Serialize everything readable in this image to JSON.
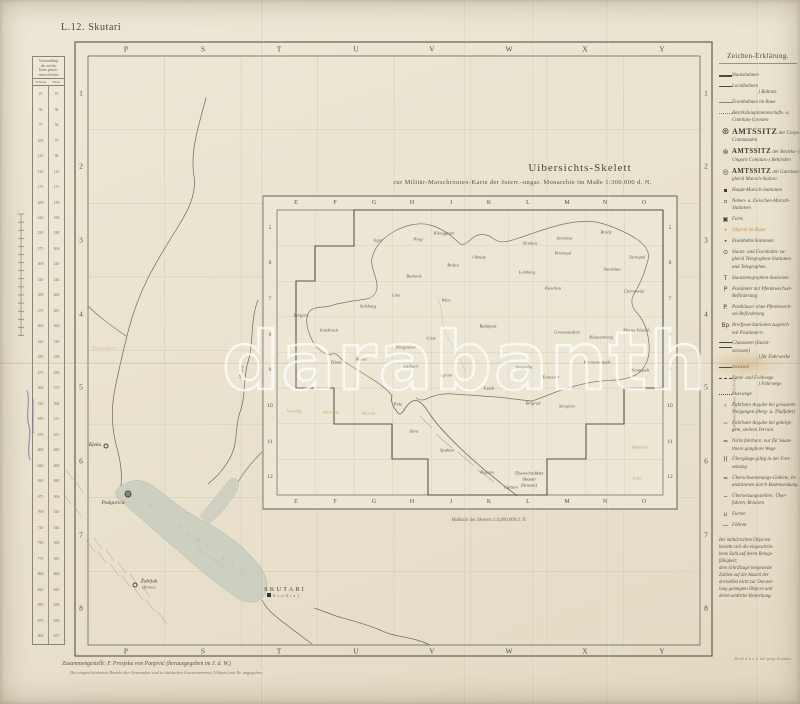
{
  "sheet": {
    "code": "L.12. Skutari"
  },
  "title": {
    "line1": "Uibersichts-Skelett",
    "line2": "zur Militär-Marschrouten-Karte der österr.-ungar. Monarchie im Maße 1:300.000 d. N."
  },
  "frame": {
    "top_letters": [
      "P",
      "S",
      "T",
      "U",
      "V",
      "W",
      "X",
      "Y"
    ],
    "bottom_letters": [
      "P",
      "S",
      "T",
      "U",
      "V",
      "W",
      "X",
      "Y"
    ],
    "left_numbers": [
      "1",
      "2",
      "3",
      "4",
      "5",
      "6",
      "7",
      "8"
    ],
    "right_numbers": [
      "1",
      "2",
      "3",
      "4",
      "5",
      "6",
      "7",
      "8"
    ]
  },
  "conversion_table": {
    "title_lines": [
      "Verwandlung",
      "der auf der",
      "Karte gemes-",
      "senen Schritte"
    ],
    "col_heads": [
      "Schritte",
      "Meter"
    ],
    "rows": [
      [
        "25",
        "19"
      ],
      [
        "50",
        "38"
      ],
      [
        "75",
        "56"
      ],
      [
        "100",
        "75"
      ],
      [
        "125",
        "94"
      ],
      [
        "150",
        "113"
      ],
      [
        "175",
        "131"
      ],
      [
        "200",
        "150"
      ],
      [
        "225",
        "169"
      ],
      [
        "250",
        "188"
      ],
      [
        "275",
        "206"
      ],
      [
        "300",
        "225"
      ],
      [
        "325",
        "244"
      ],
      [
        "350",
        "263"
      ],
      [
        "375",
        "281"
      ],
      [
        "400",
        "300"
      ],
      [
        "425",
        "319"
      ],
      [
        "450",
        "338"
      ],
      [
        "475",
        "356"
      ],
      [
        "500",
        "375"
      ],
      [
        "525",
        "394"
      ],
      [
        "550",
        "413"
      ],
      [
        "575",
        "431"
      ],
      [
        "600",
        "450"
      ],
      [
        "625",
        "469"
      ],
      [
        "650",
        "488"
      ],
      [
        "675",
        "506"
      ],
      [
        "700",
        "525"
      ],
      [
        "725",
        "544"
      ],
      [
        "750",
        "563"
      ],
      [
        "775",
        "581"
      ],
      [
        "800",
        "600"
      ],
      [
        "825",
        "619"
      ],
      [
        "850",
        "638"
      ],
      [
        "875",
        "656"
      ],
      [
        "900",
        "675"
      ]
    ]
  },
  "legend": {
    "title": "Zeichen-Erklärung.",
    "rotated_note": "Fahrbare Angaben in Schritten",
    "items": [
      {
        "sym": "rail-major",
        "lines": [
          "Staatsbahnen"
        ]
      },
      {
        "sym": "rail-minor",
        "lines": [
          "Localbahnen"
        ],
        "group": "Bahnen"
      },
      {
        "sym": "line-border",
        "lines": [
          "Eisenbahnen im Baue"
        ]
      },
      {
        "sym": "line-thin",
        "lines": [
          "Bezirkshauptmannschafts- u.",
          "Comitats-Grenzen"
        ]
      },
      {
        "glyph": "⊛",
        "em": 2,
        "lines": [
          "AMTSSITZ der Corps-",
          "Commanden"
        ]
      },
      {
        "glyph": "⊛",
        "em": 1,
        "lines": [
          "AMTSSITZ der Bezirks- (in",
          "Ungarn Comitats-) Behörden"
        ]
      },
      {
        "glyph": "◎",
        "em": 1,
        "lines": [
          "AMTSSITZ mit Garnison zu-",
          "gleich Marsch-Station"
        ]
      },
      {
        "glyph": "▪",
        "lines": [
          "Haupt-Marsch-Stationen"
        ]
      },
      {
        "glyph": "▫",
        "lines": [
          "Neben- u. Zwischen-Marsch-",
          "Stationen"
        ]
      },
      {
        "glyph": "▣",
        "lines": [
          "Forts"
        ]
      },
      {
        "glyph": "•",
        "orange": true,
        "lines": [
          "Objecte im Baue"
        ]
      },
      {
        "glyph": "•",
        "lines": [
          "Eisenbahn-Stationen"
        ]
      },
      {
        "glyph": "⊙",
        "lines": [
          "Staats- und Eisenbahn- zu-",
          "gleich Telegraphen-Stationen",
          "und Telegraphen"
        ]
      },
      {
        "glyph": "T",
        "lines": [
          "Staatstelegraphen-Stationen"
        ]
      },
      {
        "glyph": "P",
        "lines": [
          "Postämter mit Pferdewechsel-",
          "Beförderung"
        ]
      },
      {
        "glyph": "P.",
        "lines": [
          "Posthäuser ohne Pferdewech-",
          "sel-Beförderung"
        ]
      },
      {
        "glyph": "Bp",
        "lines": [
          "Briefpost-Stationen zugleich",
          "mit Postämtern"
        ]
      },
      {
        "sym": "road-double",
        "lines": [
          "Chausseen (Kunst-",
          "strassen)"
        ],
        "group": "für Fuhrwerke"
      },
      {
        "sym": "road-solid",
        "lines": [
          "Strassen"
        ]
      },
      {
        "sym": "road-dash",
        "lines": [
          "Land- und Feldwege"
        ],
        "group": "Fahrwege"
      },
      {
        "sym": "road-dot",
        "lines": [
          "Fusswege"
        ]
      },
      {
        "glyph": "›",
        "lines": [
          "Fahrbare Angabe bei grösseren",
          "Steigungen (Berg- u. Thalfahrt)"
        ]
      },
      {
        "glyph": "~",
        "lines": [
          "Fahrbare Angabe bei gebirgi-",
          "gem, steilem Terrain"
        ]
      },
      {
        "glyph": "=",
        "lines": [
          "Nicht fahrbare, nur für Saum-",
          "thiere gangbare Wege"
        ]
      },
      {
        "glyph": ")(",
        "lines": [
          "Übergänge giltig in der Fort-",
          "setzung"
        ]
      },
      {
        "glyph": "≈",
        "lines": [
          "Überschwemmungs-Gebiete, In-",
          "undationen durch Bodensenkung"
        ]
      },
      {
        "glyph": "⌣",
        "lines": [
          "Übersetzungsstellen: Über-",
          "fuhren, Brücken"
        ]
      },
      {
        "glyph": "∪",
        "lines": [
          "Furten"
        ]
      },
      {
        "glyph": "—",
        "lines": [
          "Fähren"
        ]
      },
      {
        "note": true,
        "lines": [
          "Bei militärischen Objecten",
          "bezieht sich die eingeschrie-",
          "bene Zahl auf deren Belags-",
          "fähigkeit;",
          "dem Schriftzuge beigesetzte",
          "Zahlen auf die Anzahl der",
          "dortselbst nicht zur Darstel-",
          "lung gelangten Objecte und",
          "deren amtliche Bemerkung."
        ]
      }
    ]
  },
  "inset": {
    "col_letters": [
      "E",
      "F",
      "G",
      "H",
      "J",
      "K",
      "L",
      "M",
      "N",
      "O"
    ],
    "row_numbers": [
      "5",
      "6",
      "7",
      "8",
      "9",
      "10",
      "11",
      "12"
    ],
    "caption": "Maßstab des Skeletts 1:4,600.000 d. N.",
    "sheet_label": [
      "Übersichtsblatt",
      "Skutari",
      "(Scutari)"
    ],
    "cities": [
      {
        "n": "Eger",
        "x": 378,
        "y": 240
      },
      {
        "n": "Prag",
        "x": 418,
        "y": 239
      },
      {
        "n": "Königgrätz",
        "x": 444,
        "y": 233
      },
      {
        "n": "Krakau",
        "x": 530,
        "y": 243
      },
      {
        "n": "Jaroslau",
        "x": 564,
        "y": 238
      },
      {
        "n": "Brody",
        "x": 606,
        "y": 232
      },
      {
        "n": "Tarnopol",
        "x": 637,
        "y": 257
      },
      {
        "n": "Budweis",
        "x": 414,
        "y": 276
      },
      {
        "n": "Brünn",
        "x": 453,
        "y": 265
      },
      {
        "n": "Olmütz",
        "x": 479,
        "y": 257
      },
      {
        "n": "Lemberg",
        "x": 527,
        "y": 272
      },
      {
        "n": "Przemysl",
        "x": 563,
        "y": 253
      },
      {
        "n": "Stanislau",
        "x": 612,
        "y": 269
      },
      {
        "n": "Czernowitz",
        "x": 634,
        "y": 291
      },
      {
        "n": "Linz",
        "x": 396,
        "y": 295
      },
      {
        "n": "Wien",
        "x": 446,
        "y": 300
      },
      {
        "n": "Kaschau",
        "x": 553,
        "y": 288
      },
      {
        "n": "Salzburg",
        "x": 368,
        "y": 306
      },
      {
        "n": "Bregenz",
        "x": 301,
        "y": 315
      },
      {
        "n": "Innsbruck",
        "x": 329,
        "y": 330
      },
      {
        "n": "Trient",
        "x": 336,
        "y": 362
      },
      {
        "n": "Bozen",
        "x": 361,
        "y": 359
      },
      {
        "n": "Klagenfurt",
        "x": 406,
        "y": 347
      },
      {
        "n": "Graz",
        "x": 431,
        "y": 338
      },
      {
        "n": "Laibach",
        "x": 411,
        "y": 366
      },
      {
        "n": "Agram",
        "x": 446,
        "y": 375
      },
      {
        "n": "Budapest",
        "x": 488,
        "y": 326
      },
      {
        "n": "Grosswardein",
        "x": 567,
        "y": 332
      },
      {
        "n": "Klausenburg",
        "x": 601,
        "y": 337
      },
      {
        "n": "Maros-Vásárh.",
        "x": 637,
        "y": 330
      },
      {
        "n": "Hermannstadt",
        "x": 597,
        "y": 362
      },
      {
        "n": "Kronstadt",
        "x": 640,
        "y": 370
      },
      {
        "n": "Szegedin",
        "x": 524,
        "y": 367
      },
      {
        "n": "Temesvár",
        "x": 551,
        "y": 377
      },
      {
        "n": "Essek",
        "x": 489,
        "y": 388
      },
      {
        "n": "Pola",
        "x": 398,
        "y": 404
      },
      {
        "n": "Zara",
        "x": 414,
        "y": 431
      },
      {
        "n": "Spalato",
        "x": 447,
        "y": 450
      },
      {
        "n": "Serajevo",
        "x": 567,
        "y": 406
      },
      {
        "n": "Belgrad",
        "x": 533,
        "y": 403
      },
      {
        "n": "Ragusa",
        "x": 487,
        "y": 472
      },
      {
        "n": "Cattaro",
        "x": 511,
        "y": 487
      }
    ],
    "foreign": [
      {
        "n": "Venedig",
        "x": 294,
        "y": 411
      },
      {
        "n": "Ravenna",
        "x": 331,
        "y": 412
      },
      {
        "n": "Ancona",
        "x": 368,
        "y": 413
      },
      {
        "n": "Bukarest",
        "x": 640,
        "y": 447
      },
      {
        "n": "Sofia",
        "x": 637,
        "y": 478
      }
    ]
  },
  "map": {
    "lake_label_1": "S C U T A R I - S E E",
    "lake_label_2": "(Skadarsko Blato)",
    "river_label": "Morača",
    "orange_label": "Danilovgrad",
    "places": [
      {
        "n": "Rjeka",
        "x": 95,
        "y": 445,
        "mx": 106,
        "my": 446,
        "marker": "dot"
      },
      {
        "n": "Podgorica",
        "x": 113,
        "y": 503,
        "mx": 128,
        "my": 494,
        "marker": "town"
      },
      {
        "n": "Žabljak",
        "sub": "(Ruine)",
        "x": 149,
        "y": 584,
        "mx": 135,
        "my": 585,
        "marker": "dot"
      },
      {
        "n": "SKUTARI",
        "sub": "(Scodra)",
        "x": 285,
        "y": 592,
        "mx": 269,
        "my": 595,
        "marker": "square",
        "caps": true
      }
    ]
  },
  "footer": {
    "line1": "Zusammengestellt:  F. Prosjeka  von  Panjević   (herausgegeben im J. d. W.)",
    "line2": "Die eingeschriebenen Bezirke der Gemeinden sind in türkischen Gouvernements (Vilajets) mit Nr. angegeben.",
    "imprint": "Druck d. k. u. k. mil.-geogr. Institutes."
  },
  "watermark": "darabanth"
}
